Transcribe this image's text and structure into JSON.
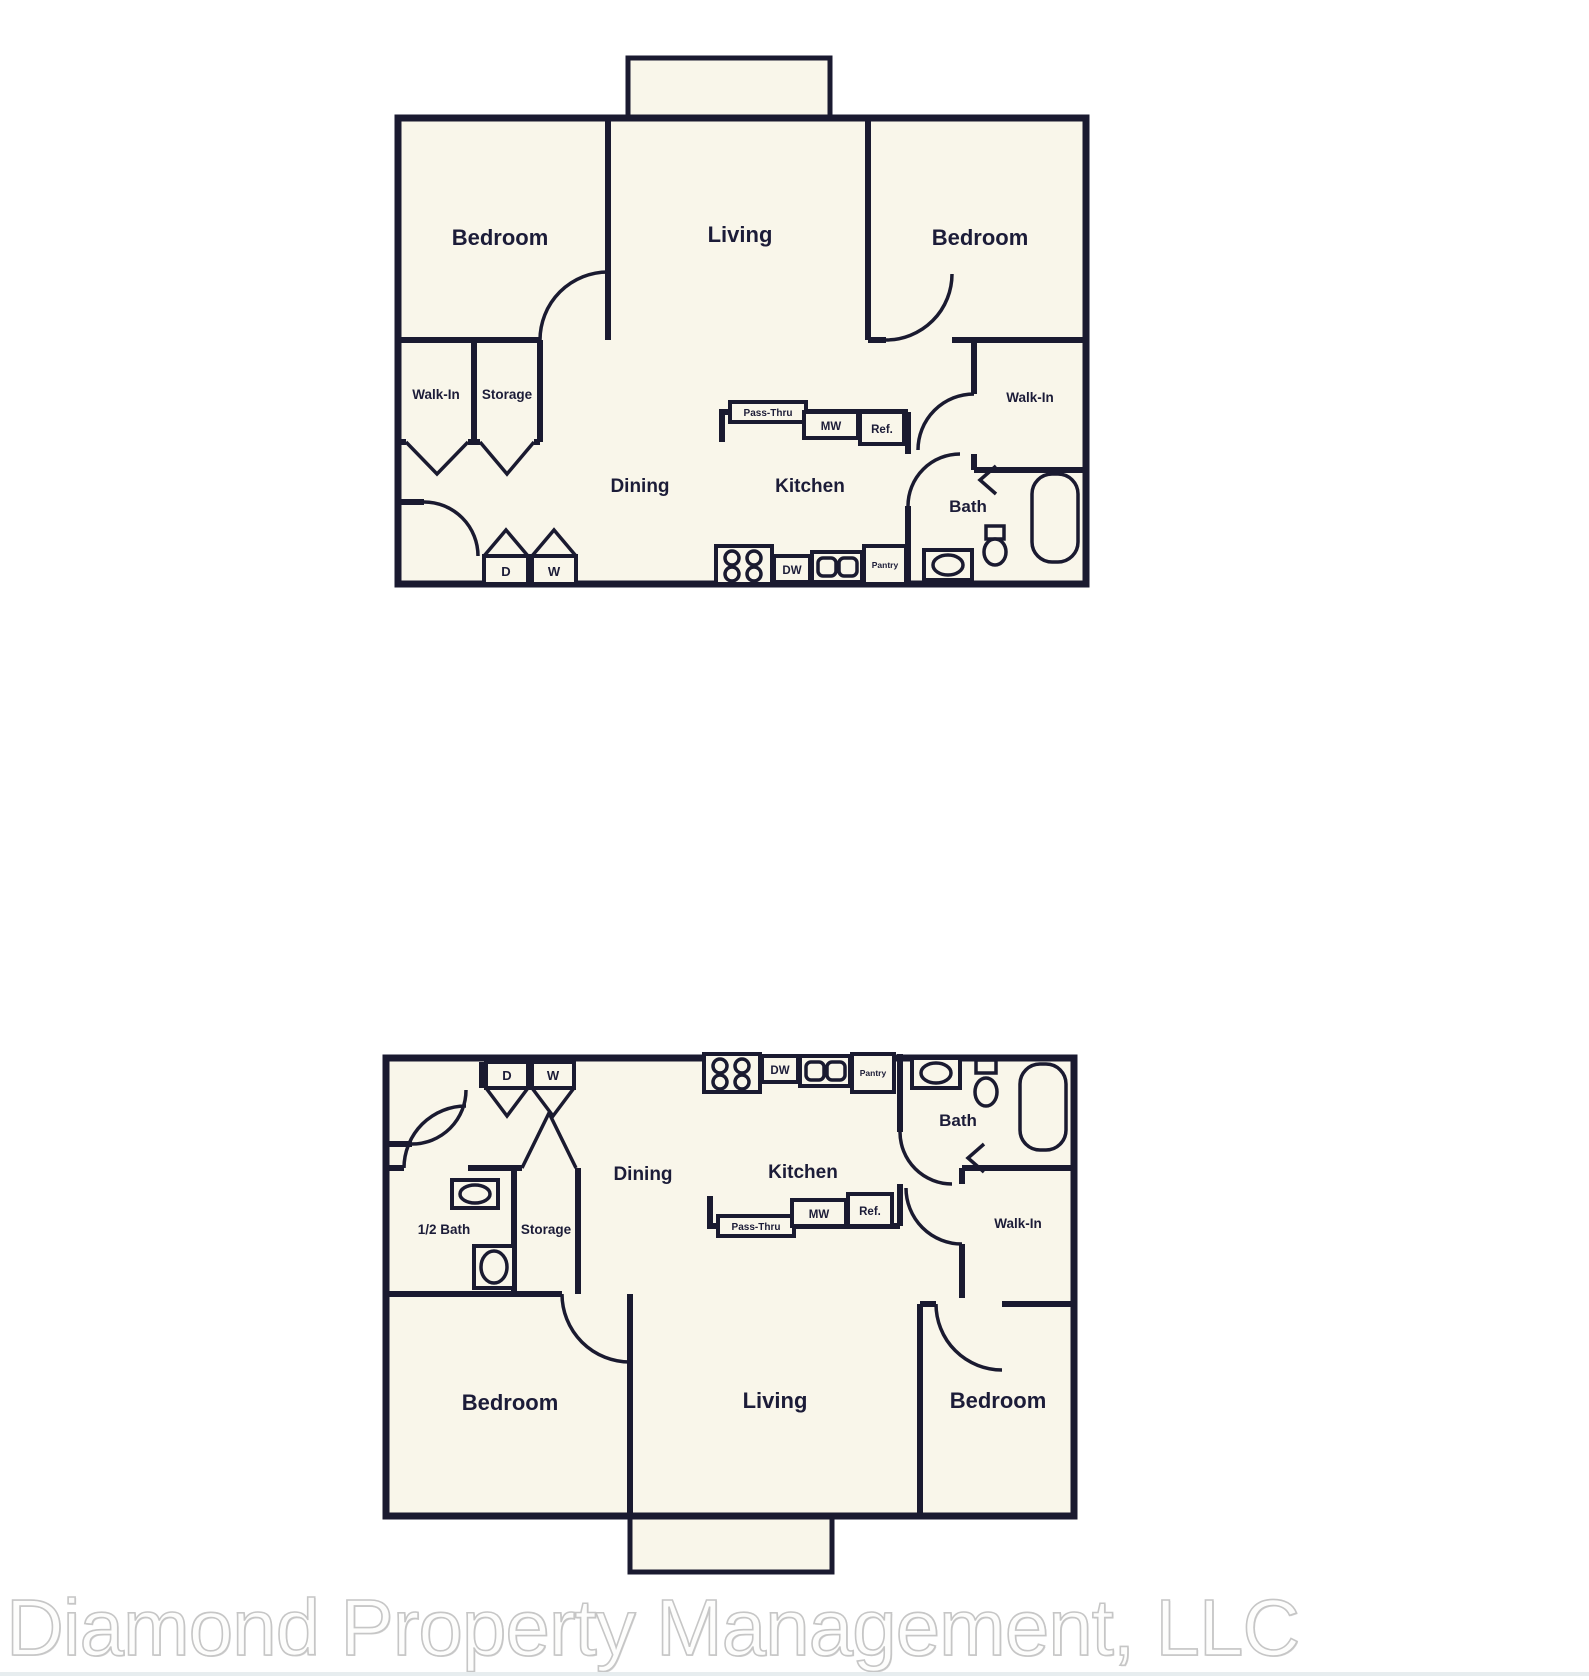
{
  "watermark": {
    "text": "Diamond Property Management, LLC"
  },
  "colors": {
    "wall": "#1a1a30",
    "paper": "#f9f6ea",
    "label": "#1c1c38",
    "watermark_fill": "#fdfdfc",
    "watermark_stroke": "#c6c6c6",
    "background": "#ffffff"
  },
  "plan_top": {
    "rooms": {
      "bedroom_left": "Bedroom",
      "living": "Living",
      "bedroom_right": "Bedroom",
      "walk_in_left": "Walk-In",
      "storage": "Storage",
      "dining": "Dining",
      "kitchen": "Kitchen",
      "bath": "Bath",
      "walk_in_right": "Walk-In"
    },
    "appliances": {
      "pass_thru": "Pass-Thru",
      "microwave": "MW",
      "refrigerator": "Ref.",
      "dishwasher": "DW",
      "pantry": "Pantry",
      "dryer": "D",
      "washer": "W"
    }
  },
  "plan_bottom": {
    "rooms": {
      "dining": "Dining",
      "kitchen": "Kitchen",
      "bath": "Bath",
      "half_bath": "1/2 Bath",
      "storage": "Storage",
      "walk_in": "Walk-In",
      "bedroom_left": "Bedroom",
      "living": "Living",
      "bedroom_right": "Bedroom"
    },
    "appliances": {
      "pass_thru": "Pass-Thru",
      "microwave": "MW",
      "refrigerator": "Ref.",
      "dishwasher": "DW",
      "pantry": "Pantry",
      "dryer": "D",
      "washer": "W"
    }
  }
}
